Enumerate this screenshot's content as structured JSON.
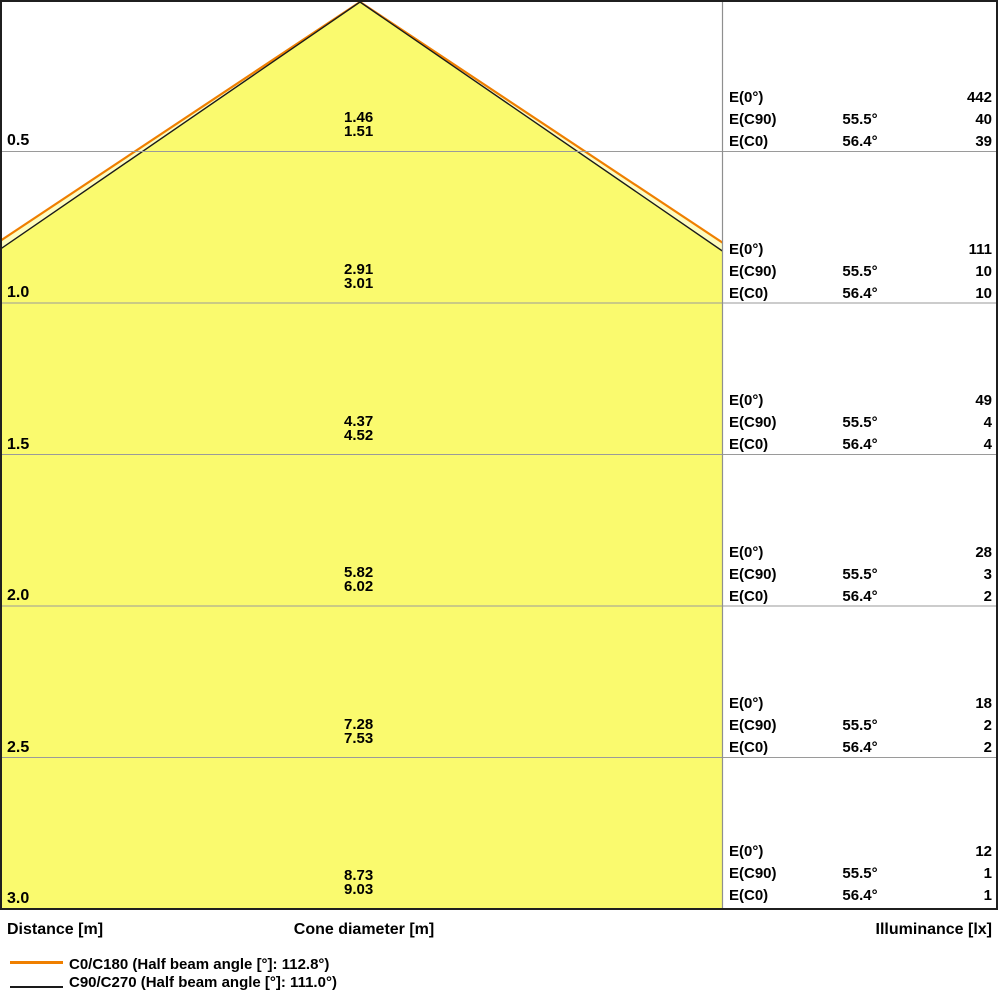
{
  "chart_data": {
    "type": "table",
    "title": "Luminaire light cone diagram",
    "columns": [
      "Distance [m]",
      "Cone diameter [m]",
      "Illuminance [lx]"
    ],
    "distances_m": [
      0.5,
      1.0,
      1.5,
      2.0,
      2.5,
      3.0
    ],
    "cone_diameter_c90_c270_m": [
      1.46,
      2.91,
      4.37,
      5.82,
      7.28,
      8.73
    ],
    "cone_diameter_c0_c180_m": [
      1.51,
      3.01,
      4.52,
      6.02,
      7.53,
      9.03
    ],
    "illuminance_E0_lx": [
      442,
      111,
      49,
      28,
      18,
      12
    ],
    "illuminance_EC90_lx": [
      40,
      10,
      4,
      3,
      2,
      1
    ],
    "illuminance_EC0_lx": [
      39,
      10,
      4,
      2,
      2,
      1
    ],
    "EC90_angle_deg": 55.5,
    "EC0_angle_deg": 56.4,
    "half_beam_angle_C0_C180_deg": 112.8,
    "half_beam_angle_C90_C270_deg": 111.0,
    "legend_position": "bottom-left",
    "grid": true,
    "colors": {
      "cone_fill_inner": "#FAFA6E",
      "cone_fill_outer": "#FDFDC0",
      "c0_line": "#EF7F00",
      "c90_line": "#1A1A1A",
      "gridline": "#9A9A9A",
      "frame": "#1F1F1F"
    }
  },
  "rows": [
    {
      "distance": "0.5",
      "cone_c90": "1.46",
      "cone_c0": "1.51",
      "e0": "442",
      "ec90": "40",
      "ec0": "39"
    },
    {
      "distance": "1.0",
      "cone_c90": "2.91",
      "cone_c0": "3.01",
      "e0": "111",
      "ec90": "10",
      "ec0": "10"
    },
    {
      "distance": "1.5",
      "cone_c90": "4.37",
      "cone_c0": "4.52",
      "e0": "49",
      "ec90": "4",
      "ec0": "4"
    },
    {
      "distance": "2.0",
      "cone_c90": "5.82",
      "cone_c0": "6.02",
      "e0": "28",
      "ec90": "3",
      "ec0": "2"
    },
    {
      "distance": "2.5",
      "cone_c90": "7.28",
      "cone_c0": "7.53",
      "e0": "18",
      "ec90": "2",
      "ec0": "2"
    },
    {
      "distance": "3.0",
      "cone_c90": "8.73",
      "cone_c0": "9.03",
      "e0": "12",
      "ec90": "1",
      "ec0": "1"
    }
  ],
  "e_labels": {
    "e0": "E(0°)",
    "ec90": "E(C90)",
    "ec0": "E(C0)"
  },
  "angles": {
    "c90": "55.5°",
    "c0": "56.4°",
    "none": ""
  },
  "footer": {
    "distance": "Distance [m]",
    "cone": "Cone diameter [m]",
    "illuminance": "Illuminance [lx]"
  },
  "legend": [
    {
      "label": "C0/C180 (Half beam angle [°]: 112.8°)",
      "color": "#EF7F00"
    },
    {
      "label": "C90/C270 (Half beam angle [°]: 111.0°)",
      "color": "#1A1A1A"
    }
  ]
}
